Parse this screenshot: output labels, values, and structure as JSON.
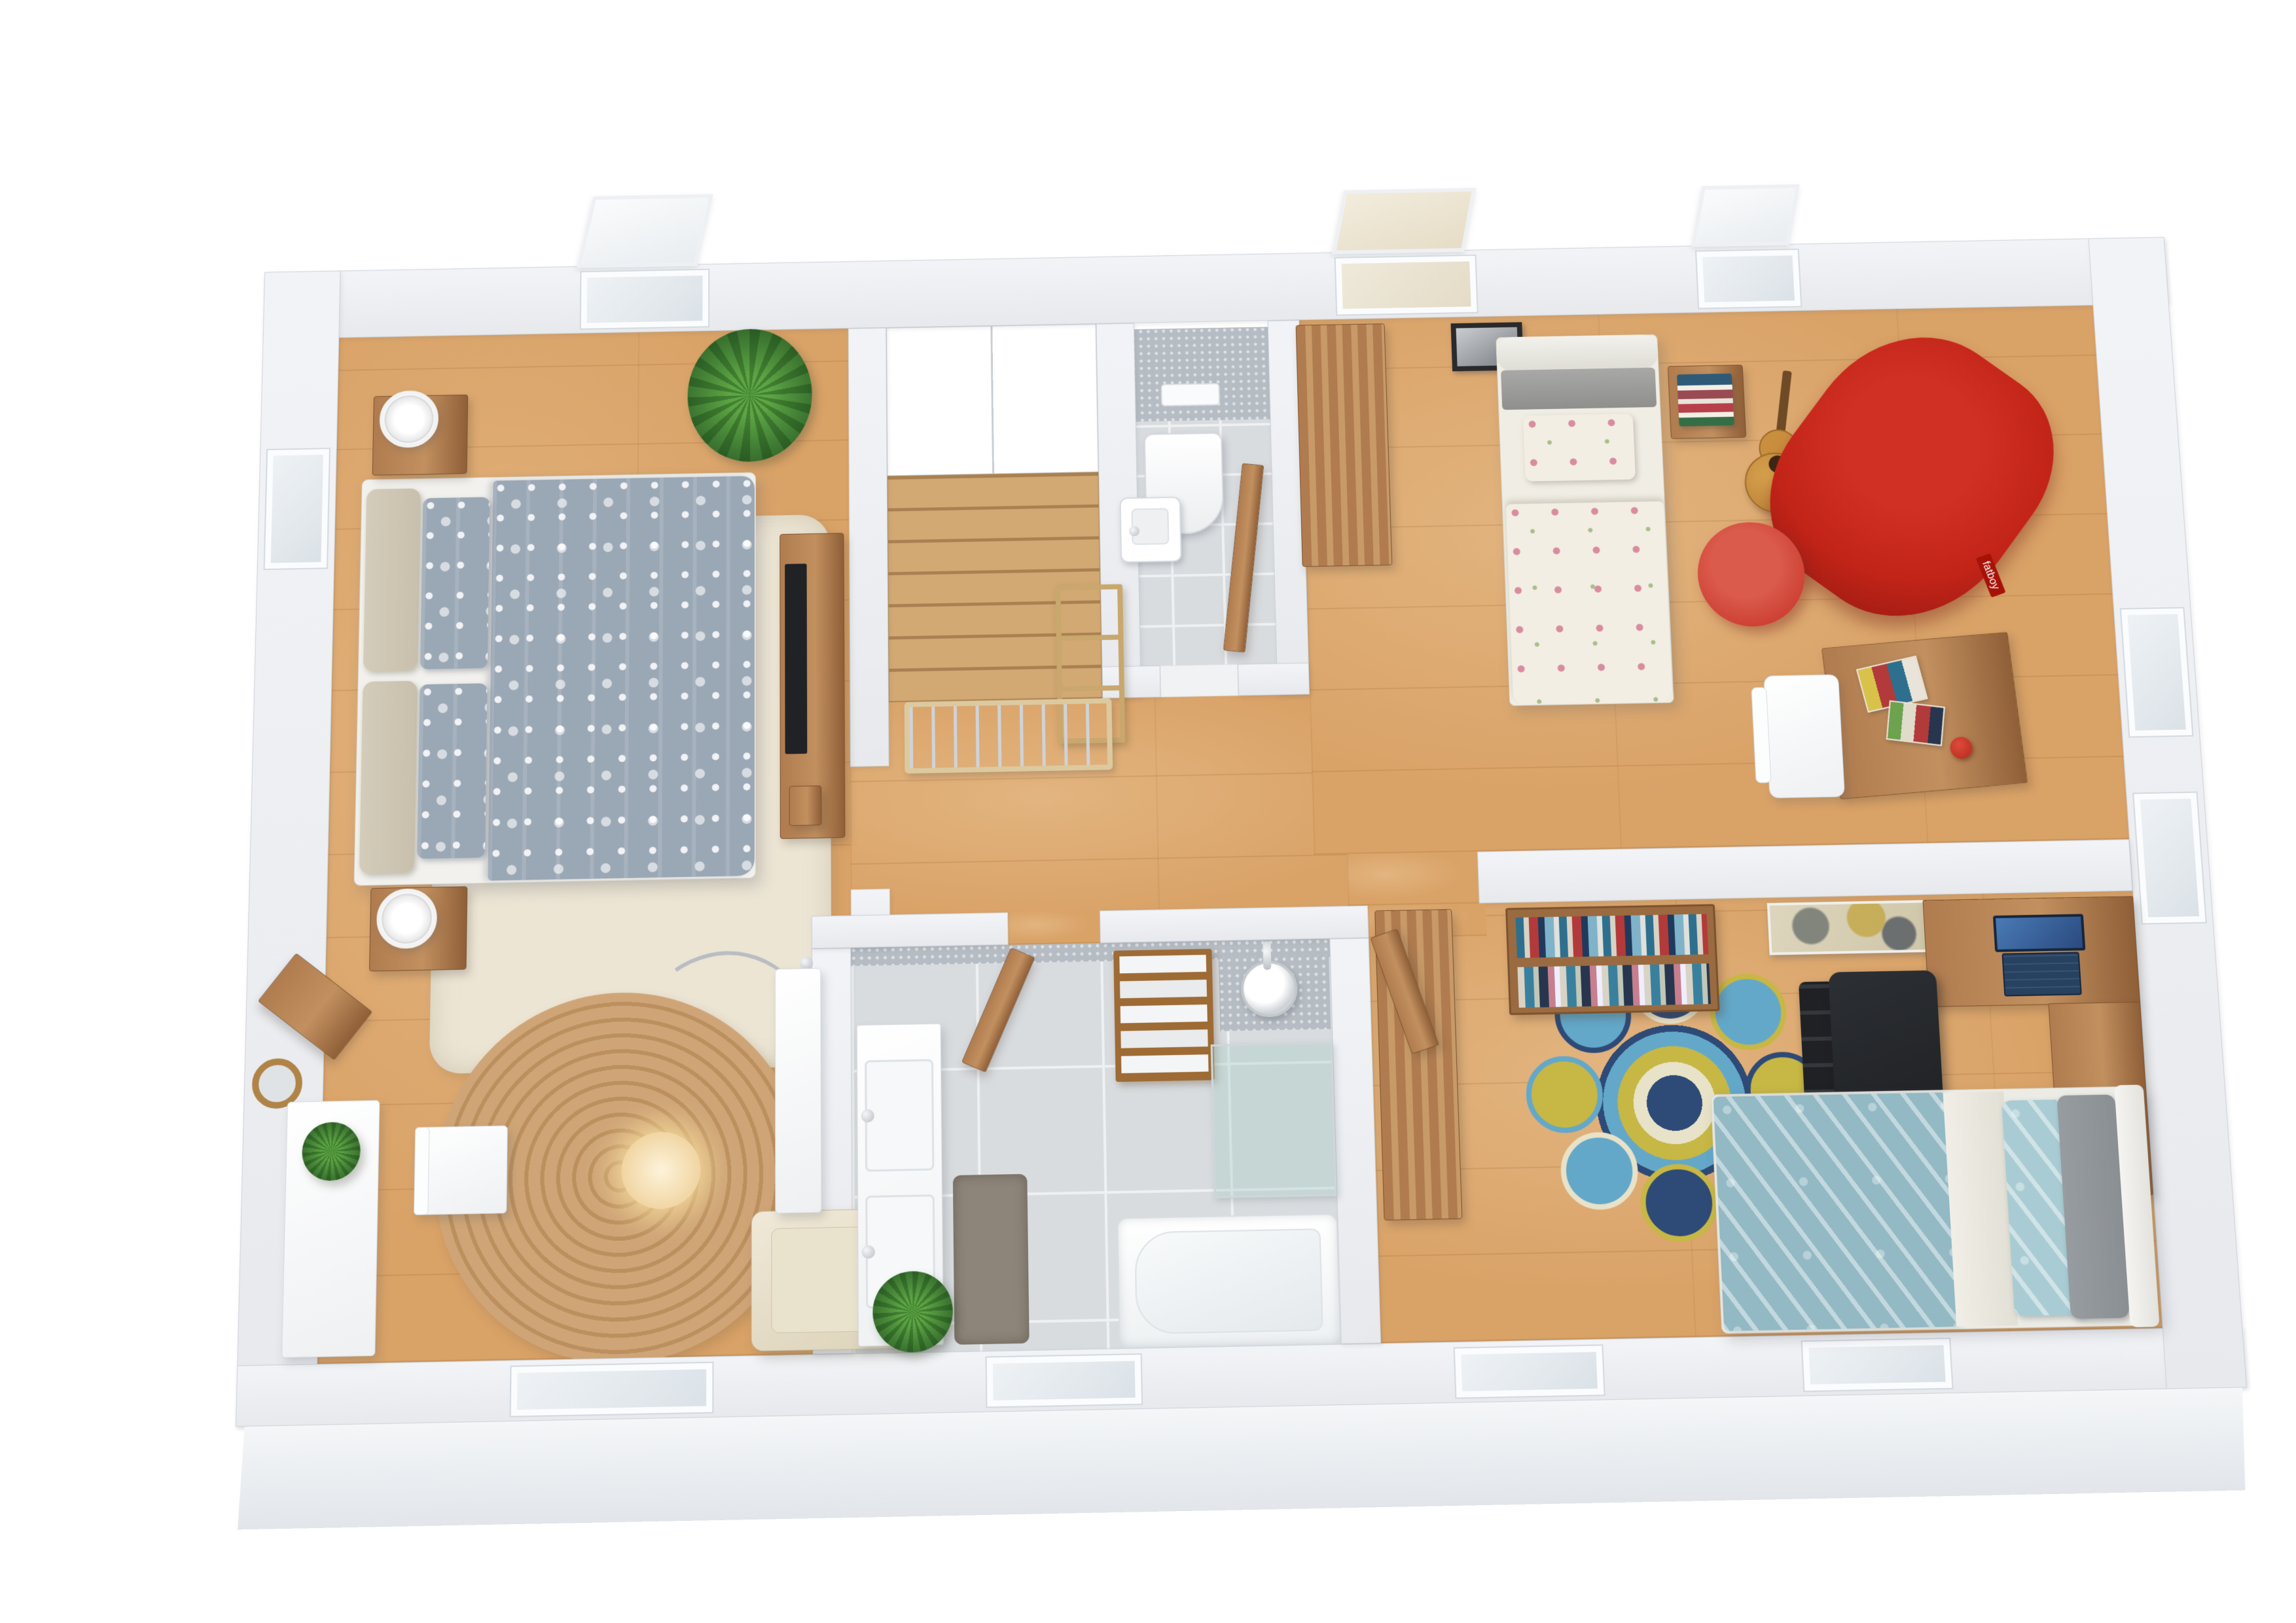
{
  "scene": {
    "type": "3d-floor-plan-render",
    "view": "top-down perspective",
    "floor": "upper storey with staircase",
    "rooms": [
      {
        "id": "master-bedroom",
        "furniture": [
          "double-bed-gray-damask",
          "nightstand-x2",
          "ring-lamp-x2",
          "shag-rug-cream",
          "tv-sideboard",
          "potted-plant-x3",
          "white-desk",
          "white-chair",
          "round-wall-mirror",
          "corner-console",
          "round-jute-rug",
          "arc-floor-lamp",
          "cream-armchair",
          "white-dresser",
          "skylight-window",
          "side-window",
          "bottom-window"
        ]
      },
      {
        "id": "stair-hall",
        "furniture": [
          "staircase",
          "open-shelf",
          "safety-gate",
          "built-in-closet"
        ]
      },
      {
        "id": "wc",
        "furniture": [
          "wall-hung-toilet",
          "flush-plate",
          "corner-washbasin",
          "mosaic-wall",
          "door-ajar"
        ]
      },
      {
        "id": "bedroom-2",
        "furniture": [
          "single-bed-floral",
          "gray-headboard",
          "nightstand-with-books",
          "acoustic-guitar",
          "red-beanbag-fatboy",
          "red-pouf",
          "wood-desk-with-magazines",
          "white-desk-chair",
          "red-desk-lamp",
          "tall-wardrobe",
          "framed-photo",
          "skylight-window-x2"
        ]
      },
      {
        "id": "bathroom",
        "furniture": [
          "double-sink-vanity",
          "gray-bath-rug",
          "potted-plant",
          "towel-ladder",
          "shower-head",
          "glass-shower-screen",
          "bathtub",
          "door-ajar",
          "mosaic-walls",
          "bottom-window"
        ]
      },
      {
        "id": "bedroom-3",
        "furniture": [
          "tall-wardrobe",
          "bookcase-with-books",
          "abstract-painting",
          "l-shaped-desk",
          "laptop",
          "black-office-chair",
          "round-mandala-rug",
          "single-bed-teal-feather",
          "open-door",
          "bottom-window-x2",
          "side-window-x2"
        ]
      }
    ]
  },
  "labels": {
    "beanbag_tag": "fatboy"
  },
  "palette": {
    "wall": "#e7e9ed",
    "wall_edge": "#ced3d9",
    "floor": "#d9a267",
    "stair": "#d2a873",
    "tile": "#d9dcdf",
    "grout": "#eef0f2",
    "mosaic": "#b6bcc3",
    "rug_cream": "#ece5d4",
    "rug_jute": "#cfa577",
    "rug_gray": "#8d8579",
    "duvet_gray": "#9aa7b5",
    "pillow_beige": "#c8c0ad",
    "floral_base": "#f2eee3",
    "floral_pink": "#d98ca0",
    "teal": "#92b9c4",
    "teal_light": "#a9ccd4",
    "pillow_gray": "#8a8f94",
    "beanbag": "#c32418",
    "pouf": "#cd4033",
    "wood": "#b07c4f",
    "wood_dark": "#8f5f38",
    "white_furn": "#eef0f2",
    "chair_black": "#1f2124",
    "laptop": "#27415f",
    "laptop_screen": "#4a7ab5",
    "glass": "#aaccc6",
    "plant": "#3f7a33",
    "plant_light": "#5da544",
    "navy": "#2e4a76",
    "blue": "#63a8c9",
    "yellow": "#c7b744",
    "cream": "#e8e2c8",
    "chrome": "#b9bdc2"
  }
}
